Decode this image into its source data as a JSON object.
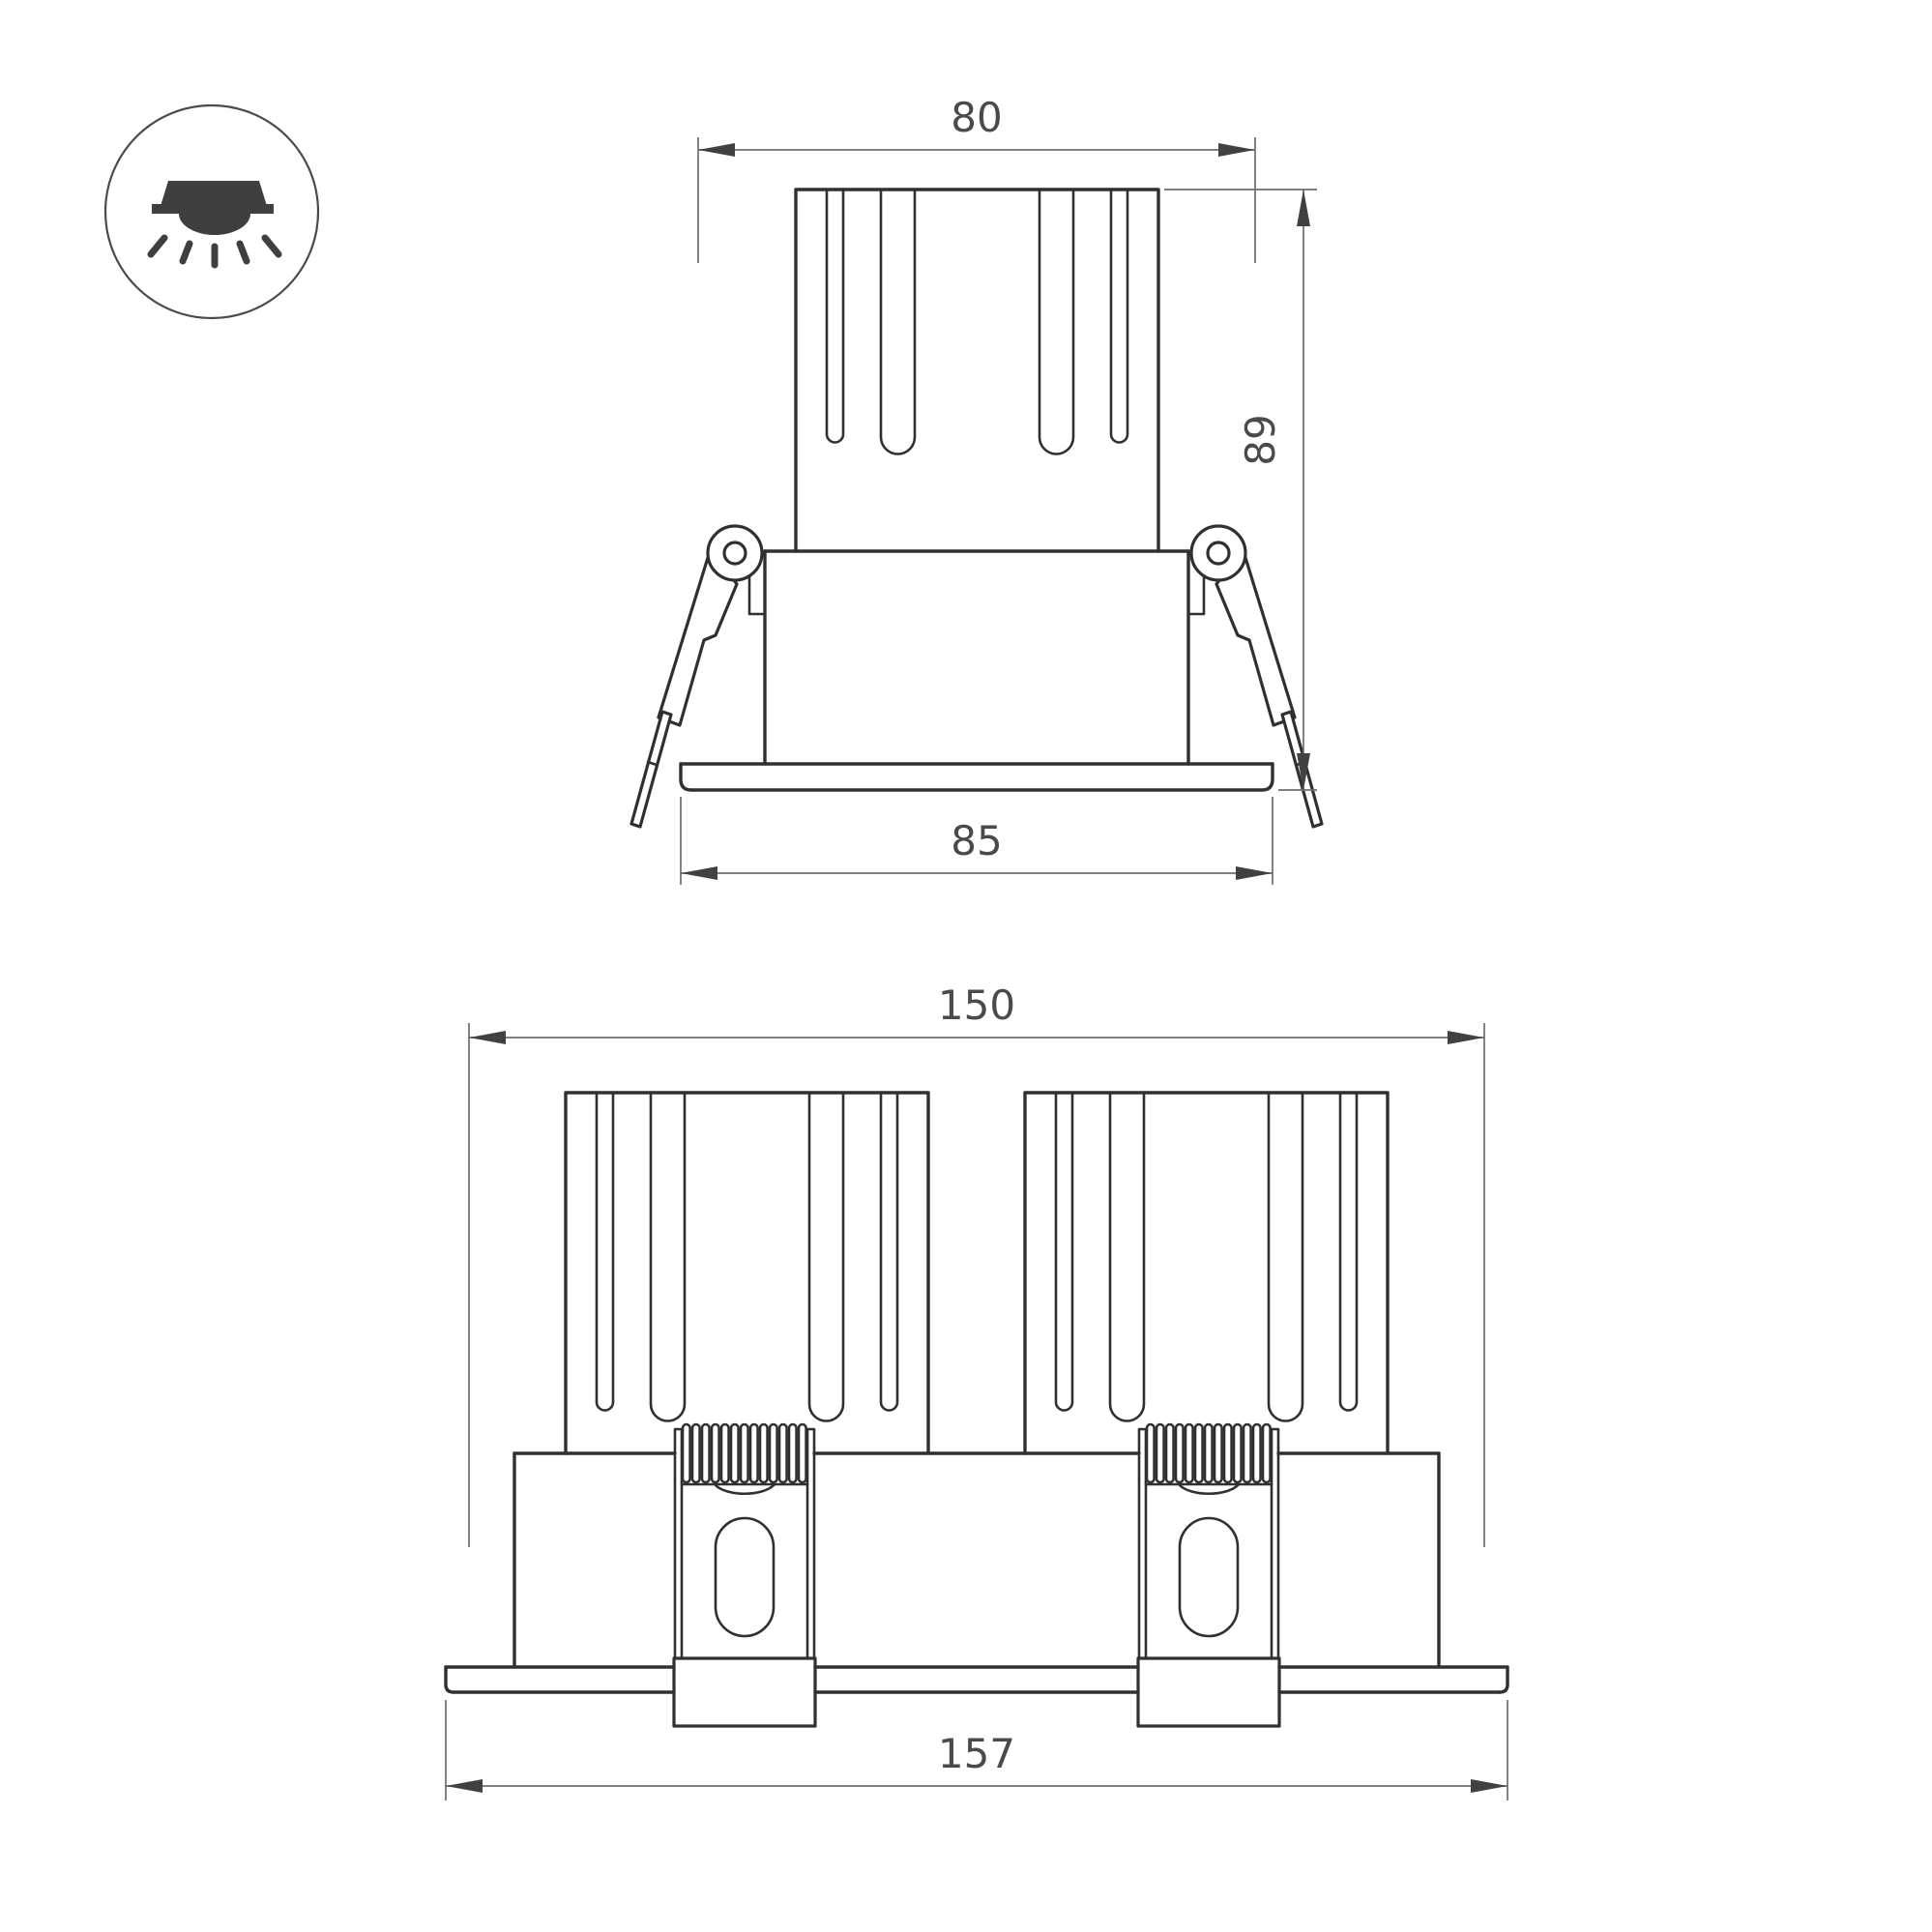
{
  "drawing": {
    "kind": "technical dimensional drawing",
    "product": "recessed twin LED downlight",
    "icon": "recessed-downlight-icon"
  },
  "single_view": {
    "dim_top_width": "80",
    "dim_height": "89",
    "dim_flange_width": "85"
  },
  "double_view": {
    "dim_top_width": "150",
    "dim_flange_width": "157"
  },
  "colors": {
    "background": "#ffffff",
    "part_line": "#303030",
    "dimension_line": "#6e6e6e",
    "arrow": "#414141",
    "text": "#4a4a4a"
  }
}
